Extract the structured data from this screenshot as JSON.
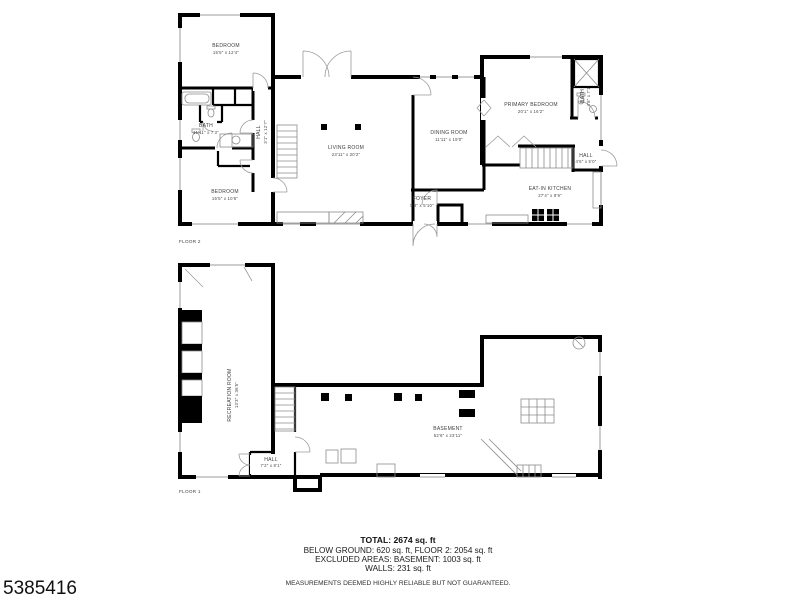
{
  "meta": {
    "id_number": "5385416"
  },
  "floor2": {
    "label": "FLOOR 2",
    "rooms": {
      "bedroom_top": {
        "name": "BEDROOM",
        "dims": "15'5\" x 12'4\""
      },
      "bath": {
        "name": "BATH",
        "dims": "11'11\" x 7'3\""
      },
      "hall": {
        "name": "HALL",
        "dims": "3'1\" x 12'7\""
      },
      "bedroom_bottom": {
        "name": "BEDROOM",
        "dims": "15'5\" x 10'6\""
      },
      "living_room": {
        "name": "LIVING ROOM",
        "dims": "23'11\" x 20'2\""
      },
      "dining_room": {
        "name": "DINING ROOM",
        "dims": "11'11\" x 19'0\""
      },
      "foyer": {
        "name": "FOYER",
        "dims": "5'4\" x 5'10\""
      },
      "primary_bedroom": {
        "name": "PRIMARY BEDROOM",
        "dims": "20'1\" x 16'2\""
      },
      "primary_bath": {
        "name": "BATH",
        "dims": "4'8\" x 7'1\""
      },
      "hall2": {
        "name": "HALL",
        "dims": "4'6\" x 5'0\""
      },
      "kitchen": {
        "name": "EAT-IN KITCHEN",
        "dims": "27'4\" x 8'9\""
      }
    }
  },
  "floor1": {
    "label": "FLOOR 1",
    "rooms": {
      "recreation_room": {
        "name": "RECREATION ROOM",
        "dims": "13'3\" x 36'5\""
      },
      "hall": {
        "name": "HALL",
        "dims": "7'2\" x 8'1\""
      },
      "basement": {
        "name": "BASEMENT",
        "dims": "52'6\" x 23'11\""
      }
    }
  },
  "summary": {
    "total": "TOTAL: 2674 sq. ft",
    "areas": "BELOW GROUND: 620 sq. ft, FLOOR 2: 2054 sq. ft",
    "excluded": "EXCLUDED AREAS: BASEMENT: 1003 sq. ft",
    "walls": "WALLS: 231 sq. ft",
    "disclaimer": "MEASUREMENTS DEEMED HIGHLY RELIABLE BUT NOT GUARANTEED."
  }
}
